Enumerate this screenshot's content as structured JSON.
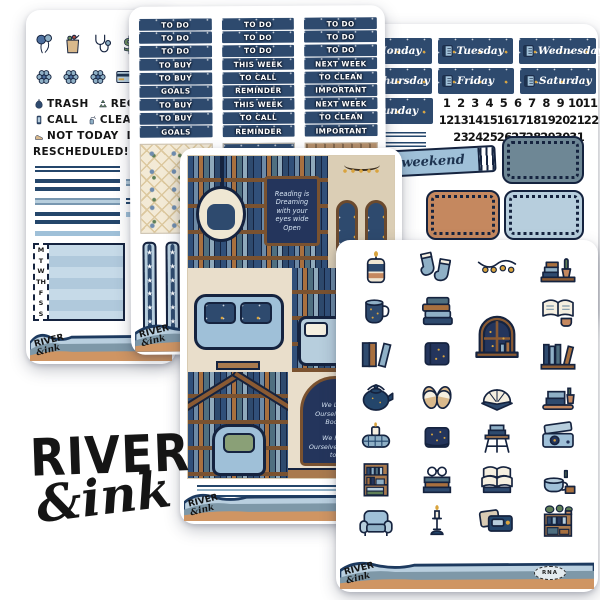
{
  "brand": {
    "big1": "RIVER",
    "big2": "&ink",
    "script1": "RIVER",
    "script2": "&ink"
  },
  "colors": {
    "navy": "#2e4a6e",
    "navy_dark": "#1d3350",
    "gold": "#d9a43e",
    "slate": "#6e8795",
    "light_blue": "#b7cedd",
    "powder_blue": "#9fc0d8",
    "tan": "#c5885f",
    "cream": "#f3ead6",
    "wood": "#a97a4e",
    "ink": "#151515"
  },
  "left_sheet": {
    "icon_rows": [
      [
        "balloons",
        "grocery-bag",
        "stethoscope",
        "dollar",
        "wallet"
      ],
      [
        "flower",
        "flower",
        "flower",
        "credit-card",
        "tv"
      ]
    ],
    "word_rows": [
      [
        {
          "icon": "trash-bag",
          "label": "TRASH"
        },
        {
          "icon": "recycle",
          "label": "RECY"
        }
      ],
      [
        {
          "icon": "phone",
          "label": "CALL"
        },
        {
          "icon": "spray",
          "label": "CLEAN"
        },
        {
          "icon": "jar",
          "label": "C"
        }
      ],
      [
        {
          "icon": "shoe",
          "label": "NOT TODAY"
        },
        {
          "icon": "",
          "label": "DONT"
        }
      ],
      [
        {
          "icon": "",
          "label": "RESCHEDULED!"
        },
        {
          "icon": "",
          "label": "MUS"
        }
      ]
    ],
    "tracker_days": [
      "M",
      "T",
      "W",
      "TH",
      "F",
      "S",
      "S"
    ]
  },
  "headers_sheet": {
    "star": "★",
    "columns": [
      [
        "TO DO",
        "TO DO",
        "TO DO",
        "TO BUY",
        "TO BUY",
        "GOALS",
        "TO BUY",
        "TO BUY",
        "GOALS"
      ],
      [
        "TO DO",
        "TO DO",
        "TO DO",
        "THIS WEEK",
        "TO CALL",
        "REMINDER",
        "THIS WEEK",
        "TO CALL",
        "REMINDER"
      ],
      [
        "TO DO",
        "TO DO",
        "TO DO",
        "NEXT WEEK",
        "TO CLEAN",
        "IMPORTANT",
        "NEXT WEEK",
        "TO CLEAN",
        "IMPORTANT"
      ]
    ]
  },
  "dates_sheet": {
    "day_rows": [
      [
        "Monday",
        "Tuesday",
        "Wednesday"
      ],
      [
        "Thursday",
        "Friday",
        "Saturday"
      ],
      [
        "Sunday"
      ]
    ],
    "number_rows": [
      [
        "1",
        "2",
        "3",
        "4",
        "5",
        "6",
        "7",
        "8",
        "9",
        "10",
        "11"
      ],
      [
        "12",
        "13",
        "14",
        "15",
        "16",
        "17",
        "18",
        "19",
        "20",
        "21",
        "22"
      ],
      [
        "23",
        "24",
        "25",
        "26",
        "27",
        "28",
        "29",
        "30",
        "31"
      ]
    ],
    "weekend_label": "weekend"
  },
  "scene_sheet": {
    "quote_board": "Reading is Dreaming with your eyes wide Open",
    "quote_arch_line1": "We Lose Ourselves in Books",
    "quote_arch_line2": "We Find Ourselves There too"
  },
  "deco_sheet": {
    "badge": "RNA",
    "stickers": [
      "candle-jar",
      "socks",
      "string-lights",
      "shelf-plant",
      "mug",
      "book-stack",
      "window",
      "open-book-mug",
      "books-upright",
      "closed-book",
      "wall-shelf",
      "kettle",
      "slippers",
      "fanned-book",
      "tray-books",
      "blanket",
      "starry-book",
      "stool-books",
      "record-player",
      "bookcase",
      "glasses-books",
      "open-books",
      "teacup-stack",
      "armchair",
      "candlestick",
      "radio-pillows",
      "plant-bookcase"
    ]
  }
}
